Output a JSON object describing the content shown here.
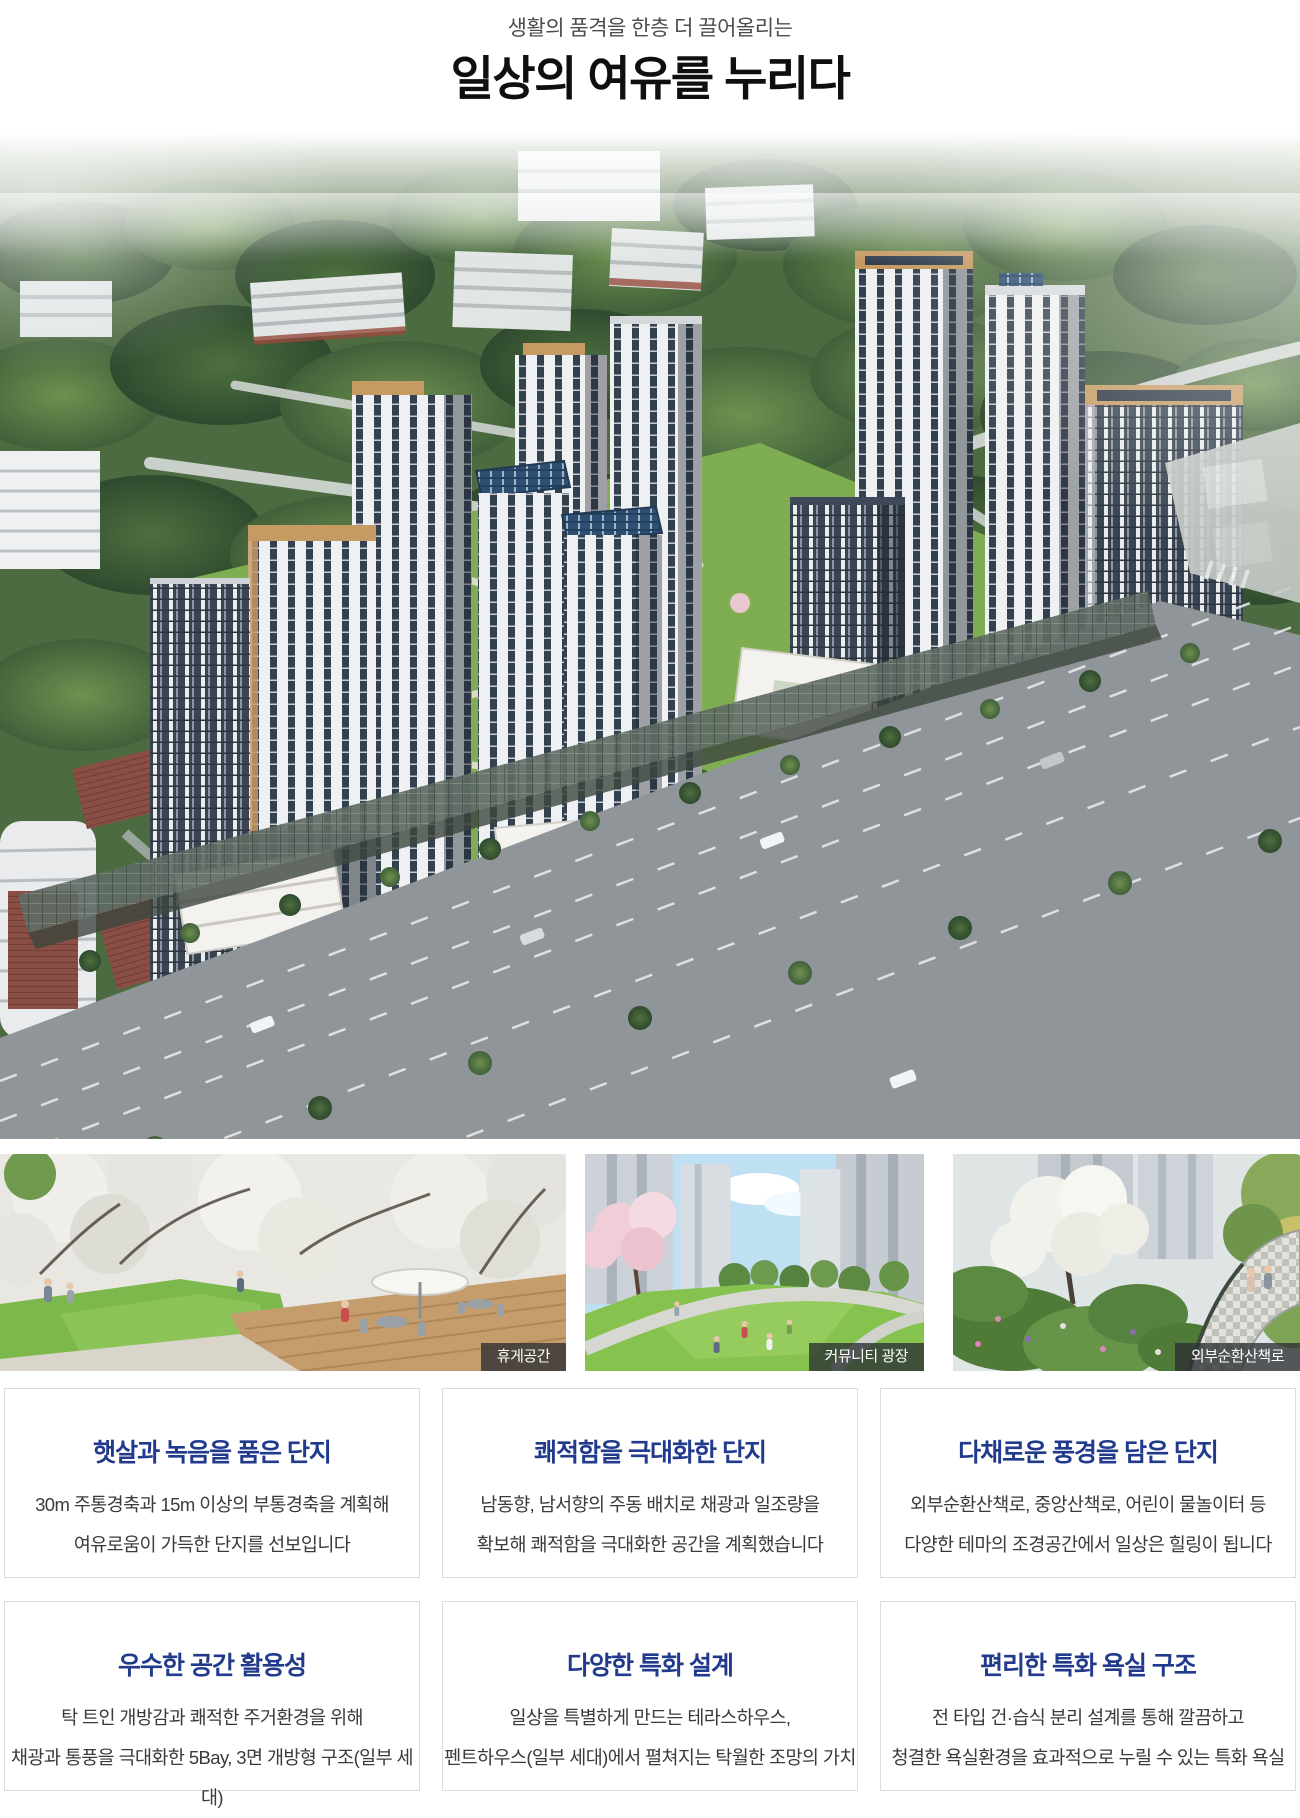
{
  "header": {
    "subtitle": "생활의 품격을 한층 더 끌어올리는",
    "title": "일상의 여유를 누리다"
  },
  "thumbnails": [
    {
      "label": "휴게공간"
    },
    {
      "label": "커뮤니티 광장"
    },
    {
      "label": "외부순환산책로"
    }
  ],
  "cards": [
    {
      "title": "햇살과 녹음을 품은 단지",
      "line1": "30m 주통경축과 15m 이상의 부통경축을 계획해",
      "line2": "여유로움이 가득한 단지를 선보입니다"
    },
    {
      "title": "쾌적함을 극대화한 단지",
      "line1": "남동향, 남서향의 주동 배치로 채광과 일조량을",
      "line2": "확보해 쾌적함을 극대화한 공간을 계획했습니다"
    },
    {
      "title": "다채로운 풍경을 담은 단지",
      "line1": "외부순환산책로, 중앙산책로, 어린이 물놀이터 등",
      "line2": "다양한 테마의 조경공간에서 일상은 힐링이 됩니다"
    },
    {
      "title": "우수한 공간 활용성",
      "line1": "탁 트인 개방감과 쾌적한 주거환경을 위해",
      "line2": "채광과 통풍을 극대화한 5Bay, 3면 개방형 구조(일부 세대)"
    },
    {
      "title": "다양한 특화 설계",
      "line1": "일상을 특별하게 만드는 테라스하우스,",
      "line2": "펜트하우스(일부 세대)에서 펼쳐지는 탁월한 조망의 가치"
    },
    {
      "title": "편리한 특화 욕실 구조",
      "line1": "전 타입 건·습식 분리 설계를 통해 깔끔하고",
      "line2": "청결한 욕실환경을 효과적으로 누릴 수 있는 특화 욕실"
    }
  ],
  "colors": {
    "accent_navy": "#213a8c",
    "body_text": "#3a3a3a",
    "card_border": "#d9dde2",
    "badge_bg": "rgba(43,48,50,0.78)",
    "badge_text": "#ffffff"
  }
}
